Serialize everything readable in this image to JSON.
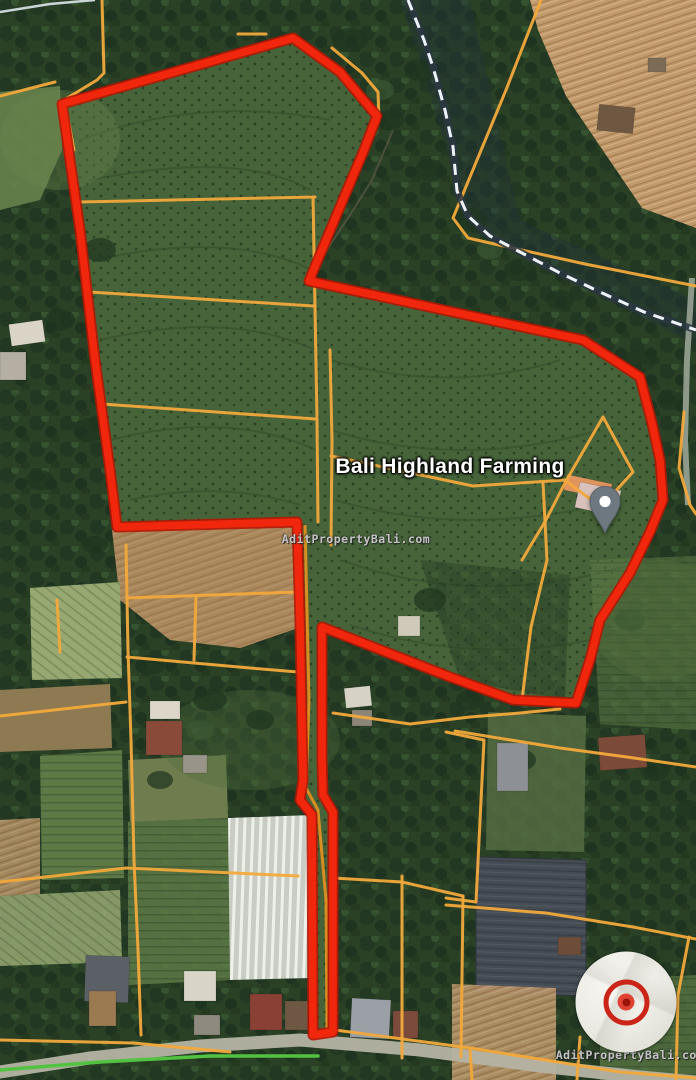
{
  "map": {
    "place": {
      "label": "Bali Highland Farming"
    },
    "watermark": "AditPropertyBali.com",
    "colors": {
      "boundary": "#f1270d",
      "boundary_casing": "#b51603",
      "parcel": "#f2a93b",
      "corridor_lane": "#e8921f",
      "dash_fill": "#edf3f7",
      "dash_casing": "#2c3742",
      "road": "#b5b3a4",
      "road_right": "#a8b0a2",
      "road_top_left": "#ccd4d8",
      "path_green": "#52c241"
    },
    "boundary_points": "62,104 293,38 340,72 377,116 364,150 345,195 309,281 583,340 640,377 652,423 660,460 663,500 650,532 630,573 600,620 590,660 576,703 513,700 450,677 322,627 322,760 323,795 333,812 333,1032 313,1035 312,815 300,800 303,780 300,620 297,522 117,527 110,470 95,360 80,230",
    "corridor_lane_points": "305,525 309,700 306,788 318,810 326,900 327,1030",
    "dashed_path_points": "408,0 424,40 433,67 445,110 453,147 457,191 468,216 490,236 520,252 560,273 600,292 644,312 696,330",
    "green_path_points": "0,1070 100,1062 210,1056 318,1056",
    "roads": {
      "main": "0,1072 90,1058 200,1046 300,1040 420,1050 540,1066 640,1077 696,1082",
      "right_edge": "692,278 687,360 685,440 688,505",
      "top_left": "0,12 50,4 95,0"
    },
    "parcel_lines": [
      "541,0 506,90 453,218 468,238 490,243 585,264 696,286",
      "102,0 104,73 97,80 64,100",
      "0,96 55,82",
      "238,34 266,34",
      "332,48 362,73 378,92 379,120 364,150 345,195",
      "78,202 315,197",
      "89,292 314,306",
      "102,404 316,419",
      "313,197 315,306 317,420 318,522",
      "330,350 332,440 331,545",
      "331,456 473,486 566,480",
      "603,417 633,472 601,507 566,481 603,417",
      "566,481 546,520 531,545 522,560",
      "543,483 547,560 531,627 522,700",
      "684,412 679,468 690,505 696,514",
      "333,713 410,724 470,717 520,713 560,709",
      "455,731 560,748 627,757 696,767",
      "126,545 128,650 131,740 134,860 138,950 141,1035",
      "127,598 298,592",
      "127,657 250,668 298,672",
      "196,596 194,660",
      "0,716 126,702",
      "0,882 126,868 298,876",
      "333,878 402,882 463,896",
      "402,876 402,1058",
      "463,896 461,1057",
      "446,732 484,740 476,902 446,898",
      "446,905 546,913 633,927 696,939",
      "689,937 678,995 676,1080",
      "580,1037 577,1080",
      "470,1050 472,1080",
      "0,1040 133,1043 230,1052",
      "335,1030 470,1048 620,1072 696,1078",
      "66,108 74,150",
      "57,600 60,652"
    ]
  },
  "controls": {
    "locate_button": {
      "name": "locate-target"
    }
  }
}
